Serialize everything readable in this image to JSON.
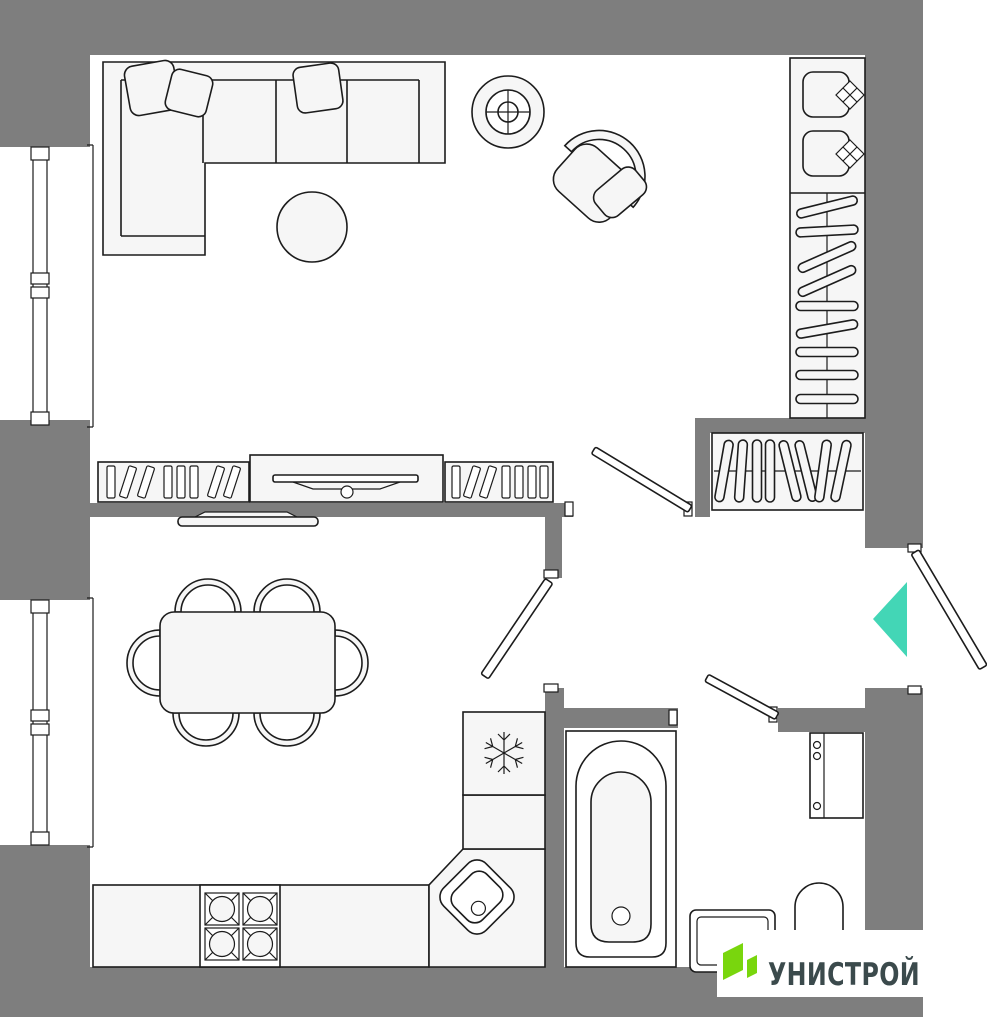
{
  "meta": {
    "kind": "apartment-floor-plan",
    "orientation": "top-down"
  },
  "colors": {
    "wall": "#7e7e7e",
    "floor": "#ffffff",
    "furniture_fill": "#f6f6f6",
    "outline": "#1c1c1c",
    "entrance_marker": "#43d6b6",
    "logo_green": "#79d60d",
    "logo_text_color": "#3b4a4c",
    "logo_bg": "#ffffff"
  },
  "logo": {
    "text": "УНИСТРОЙ",
    "icon": "unistroy-double-parallelogram-icon"
  },
  "entrance": {
    "marker": "teal-triangle-pointing-left",
    "door": "entrance-door-swing-outward"
  },
  "rooms": {
    "living_room": {
      "furniture": [
        "corner-sofa-with-pillows",
        "round-pouf",
        "ceiling-light",
        "armchair-with-pillow",
        "wardrobe-with-hangers-and-boxes",
        "media-console-with-books",
        "tv-on-console"
      ]
    },
    "kitchen_dining": {
      "furniture": [
        "dining-table",
        "six-chairs",
        "wall-tv",
        "kitchen-counter",
        "stove-four-burners",
        "corner-sink",
        "fridge-with-snowflake"
      ]
    },
    "hallway": {
      "furniture": [
        "open-closet-with-hangers"
      ]
    },
    "bathroom": {
      "furniture": [
        "bathtub",
        "washing-machine",
        "vanity-sink",
        "toilet"
      ]
    }
  },
  "windows": {
    "count": 2,
    "location": "left-wall"
  },
  "doors": {
    "count": 4,
    "list": [
      "living-room-door",
      "kitchen-door",
      "bathroom-door",
      "entrance-door"
    ]
  }
}
